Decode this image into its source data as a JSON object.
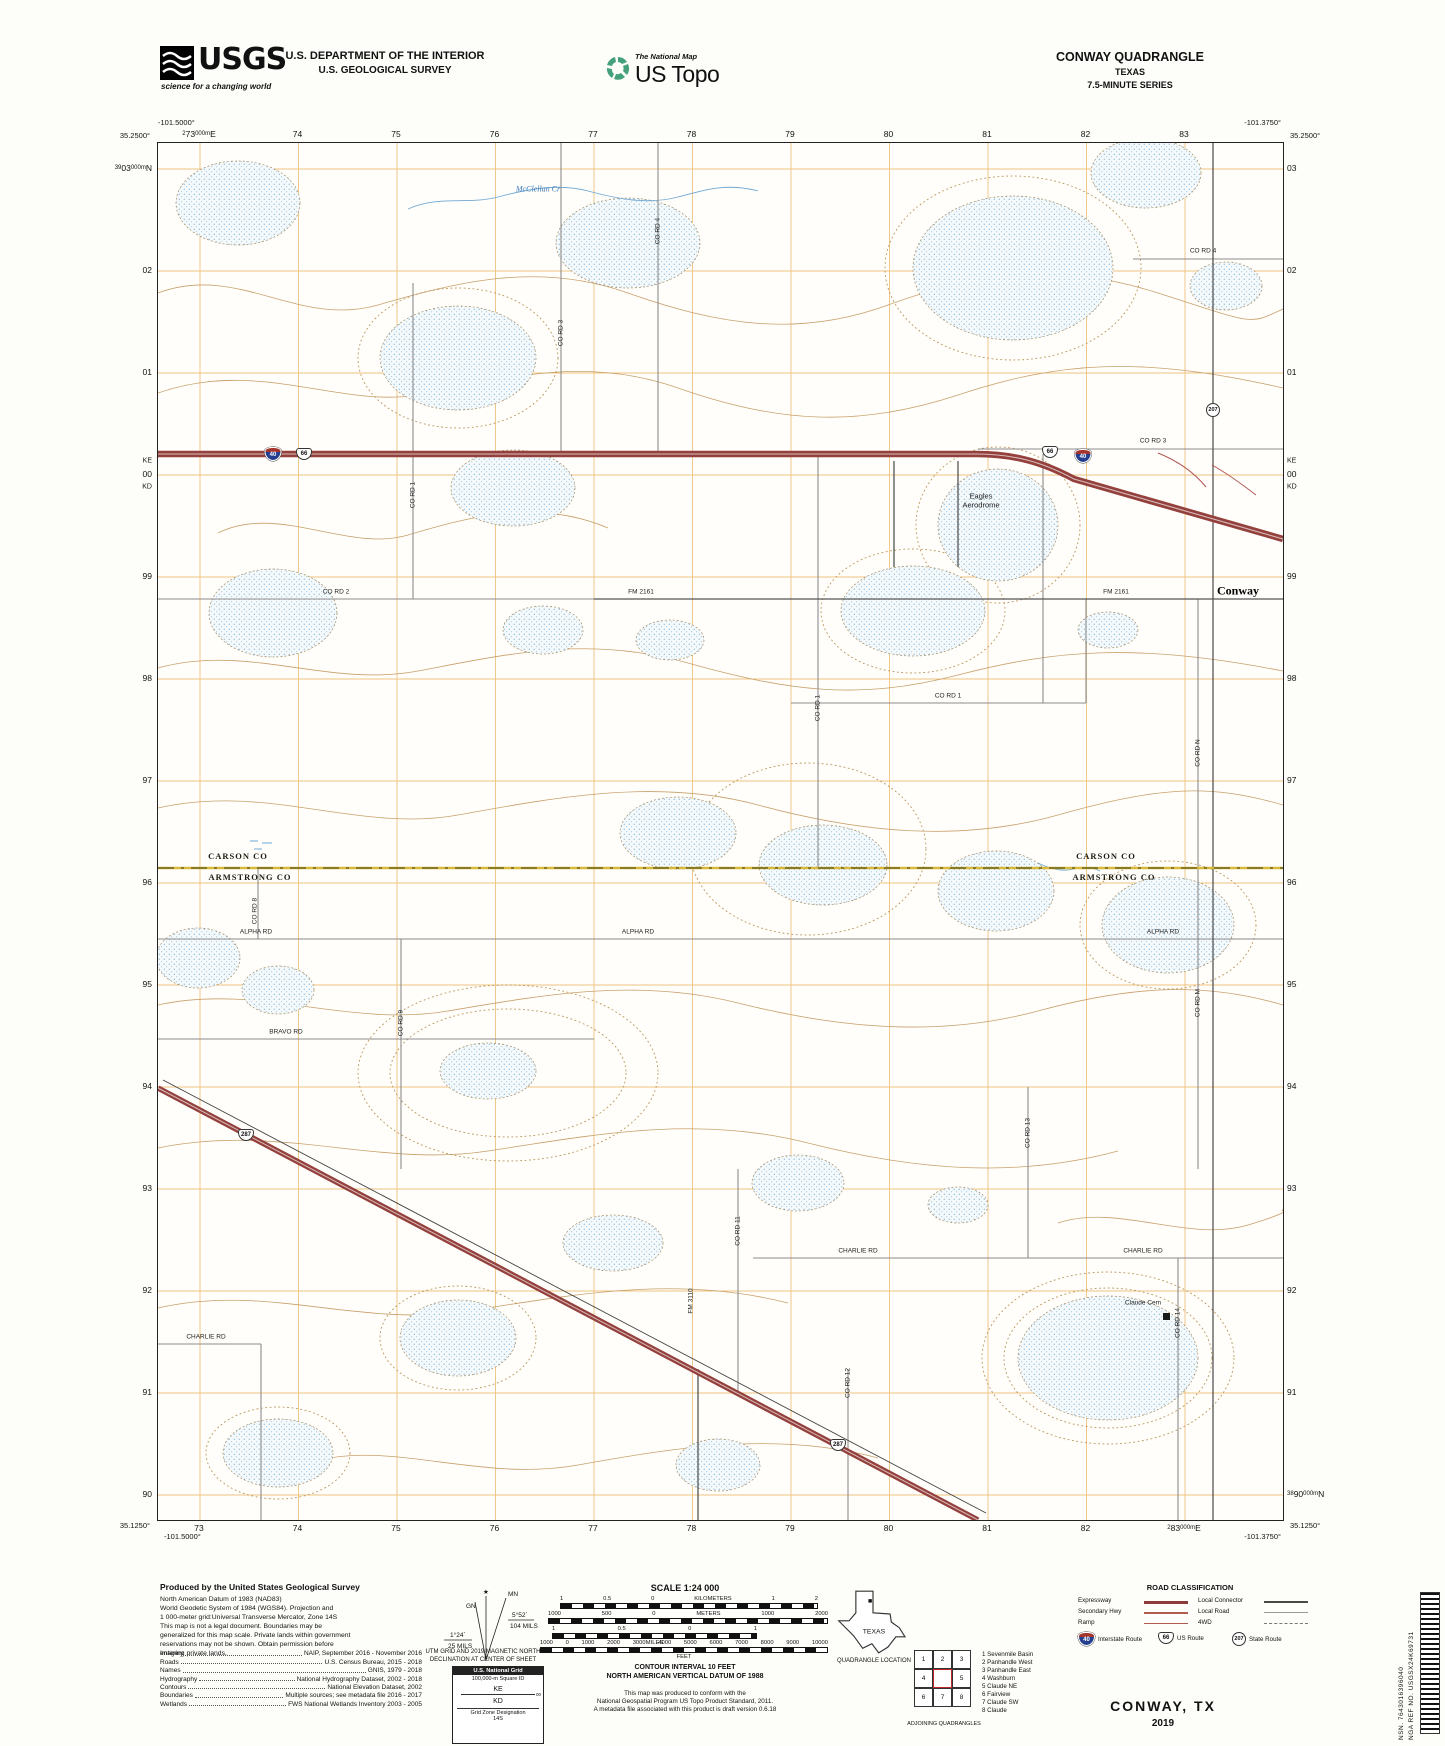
{
  "header": {
    "usgs_logo": "USGS",
    "usgs_tagline": "science for a changing world",
    "dept_line1": "U.S. DEPARTMENT OF THE INTERIOR",
    "dept_line2": "U.S. GEOLOGICAL SURVEY",
    "ustopo_small": "The National Map",
    "ustopo_large": "US Topo",
    "quad_title": "CONWAY QUADRANGLE",
    "quad_state": "TEXAS",
    "quad_series": "7.5-MINUTE SERIES"
  },
  "map": {
    "corners": {
      "tl": {
        "lon": "-101.5000°",
        "lat": "35.2500°"
      },
      "tr": {
        "lon": "-101.3750°",
        "lat": "35.2500°"
      },
      "bl": {
        "lon": "-101.5000°",
        "lat": "35.1250°"
      },
      "br": {
        "lon": "-101.3750°",
        "lat": "35.1250°"
      }
    },
    "edge": {
      "top": [
        [
          [
            "s",
            "2"
          ],
          [
            "b",
            "73"
          ],
          [
            "s",
            "000m"
          ],
          [
            "b",
            "E"
          ]
        ],
        "74",
        "75",
        "76",
        "77",
        "78",
        "79",
        "80",
        "81",
        "82",
        "83"
      ],
      "bottom": [
        "73",
        "74",
        "75",
        "76",
        "77",
        "78",
        "79",
        "80",
        "81",
        "82",
        [
          [
            "s",
            "2"
          ],
          [
            "b",
            "83"
          ],
          [
            "s",
            "000m"
          ],
          [
            "b",
            "E"
          ]
        ]
      ],
      "left": [
        [
          [
            "s",
            "39"
          ],
          [
            "b",
            "03"
          ],
          [
            "s",
            "000m"
          ],
          [
            "b",
            "N"
          ]
        ],
        "02",
        "01",
        "00",
        "99",
        "98",
        "97",
        "96",
        "95",
        "94",
        "93",
        "92",
        "91",
        "90"
      ],
      "right": [
        "03",
        "02",
        "01",
        "00",
        "99",
        "98",
        "97",
        "96",
        "95",
        "94",
        "93",
        "92",
        "91",
        [
          [
            "s",
            "38"
          ],
          [
            "b",
            "90"
          ],
          [
            "s",
            "000m"
          ],
          [
            "b",
            "N"
          ]
        ]
      ],
      "ke": "KE",
      "kd": "KD"
    },
    "labels": [
      {
        "t": "McClellan Cr",
        "x": 380,
        "y": 46,
        "c": "water"
      },
      {
        "t": "CO RD 3",
        "x": 403,
        "y": 190,
        "c": "vroad"
      },
      {
        "t": "CO RD 4",
        "x": 500,
        "y": 88,
        "c": "vroad"
      },
      {
        "t": "CO RD 4",
        "x": 1045,
        "y": 108,
        "c": "road"
      },
      {
        "t": "CO RD 3",
        "x": 995,
        "y": 298,
        "c": "road"
      },
      {
        "t": "CO RD 1",
        "x": 255,
        "y": 352,
        "c": "vroad"
      },
      {
        "t": "Eagles\nAerodrome",
        "x": 823,
        "y": 358,
        "c": "place"
      },
      {
        "t": "Conway",
        "x": 1080,
        "y": 448,
        "c": "town"
      },
      {
        "t": "CO RD 2",
        "x": 178,
        "y": 449,
        "c": "road"
      },
      {
        "t": "FM 2161",
        "x": 483,
        "y": 449,
        "c": "road"
      },
      {
        "t": "FM 2161",
        "x": 958,
        "y": 449,
        "c": "road"
      },
      {
        "t": "CO RD 1",
        "x": 790,
        "y": 553,
        "c": "road"
      },
      {
        "t": "CO RD 1",
        "x": 660,
        "y": 565,
        "c": "vroad"
      },
      {
        "t": "CO RD N",
        "x": 1040,
        "y": 610,
        "c": "vroad"
      },
      {
        "t": "CARSON CO",
        "x": 80,
        "y": 713,
        "c": "county"
      },
      {
        "t": "ARMSTRONG CO",
        "x": 92,
        "y": 734,
        "c": "county"
      },
      {
        "t": "CARSON CO",
        "x": 948,
        "y": 713,
        "c": "county"
      },
      {
        "t": "ARMSTRONG CO",
        "x": 956,
        "y": 734,
        "c": "county"
      },
      {
        "t": "CO RD 8",
        "x": 97,
        "y": 768,
        "c": "vroad"
      },
      {
        "t": "ALPHA RD",
        "x": 98,
        "y": 789,
        "c": "road"
      },
      {
        "t": "ALPHA RD",
        "x": 480,
        "y": 789,
        "c": "road"
      },
      {
        "t": "ALPHA RD",
        "x": 1005,
        "y": 789,
        "c": "road"
      },
      {
        "t": "CO RD 9",
        "x": 243,
        "y": 880,
        "c": "vroad"
      },
      {
        "t": "CO RD M",
        "x": 1040,
        "y": 860,
        "c": "vroad"
      },
      {
        "t": "BRAVO RD",
        "x": 128,
        "y": 889,
        "c": "road"
      },
      {
        "t": "CO RD 13",
        "x": 870,
        "y": 990,
        "c": "vroad"
      },
      {
        "t": "CHARLIE RD",
        "x": 700,
        "y": 1108,
        "c": "road"
      },
      {
        "t": "CHARLIE RD",
        "x": 985,
        "y": 1108,
        "c": "road"
      },
      {
        "t": "CO RD 11",
        "x": 580,
        "y": 1088,
        "c": "vroad"
      },
      {
        "t": "FM 3110",
        "x": 533,
        "y": 1158,
        "c": "vroad"
      },
      {
        "t": "CHARLIE RD",
        "x": 48,
        "y": 1194,
        "c": "road"
      },
      {
        "t": "CO RD 12",
        "x": 690,
        "y": 1240,
        "c": "vroad"
      },
      {
        "t": "CO RD 14",
        "x": 1020,
        "y": 1180,
        "c": "vroad"
      },
      {
        "t": "Claude Cem",
        "x": 985,
        "y": 1160,
        "c": "cem"
      }
    ],
    "shields": [
      {
        "k": "i",
        "n": "40",
        "x": 115,
        "y": 311
      },
      {
        "k": "u",
        "n": "66",
        "x": 146,
        "y": 311
      },
      {
        "k": "u",
        "n": "66",
        "x": 892,
        "y": 309
      },
      {
        "k": "i",
        "n": "40",
        "x": 925,
        "y": 313
      },
      {
        "k": "s",
        "n": "207",
        "x": 1055,
        "y": 267
      },
      {
        "k": "u",
        "n": "287",
        "x": 88,
        "y": 992
      },
      {
        "k": "u",
        "n": "287",
        "x": 680,
        "y": 1302
      }
    ]
  },
  "collar": {
    "produced_by": "Produced by the United States Geological Survey",
    "datum_lines": [
      "North American Datum of 1983 (NAD83)",
      "World Geodetic System of 1984 (WGS84).  Projection and",
      "1 000-meter grid:Universal Transverse Mercator, Zone 14S",
      "This map is not a legal document. Boundaries may be",
      "generalized for this map scale. Private lands within government",
      "reservations may not be shown. Obtain permission before",
      "entering private lands."
    ],
    "credits": [
      {
        "label": "Imagery",
        "value": "NAIP, September 2016 - November 2016"
      },
      {
        "label": "Roads",
        "value": "U.S. Census Bureau, 2015 - 2018"
      },
      {
        "label": "Names",
        "value": "GNIS, 1979 - 2018"
      },
      {
        "label": "Hydrography",
        "value": "National Hydrography Dataset, 2002 - 2018"
      },
      {
        "label": "Contours",
        "value": "National Elevation Dataset, 2002"
      },
      {
        "label": "Boundaries",
        "value": "Multiple sources; see metadata file 2016 - 2017"
      },
      {
        "label": "Wetlands",
        "value": "FWS National Wetlands Inventory 2003 - 2005"
      }
    ],
    "declination": {
      "star": "★",
      "gn": "GN",
      "mn": "MN",
      "east": "5°52´",
      "east_mils": "104 MILS",
      "west": "1°24´",
      "west_mils": "25 MILS",
      "caption1": "UTM GRID AND 2019 MAGNETIC NORTH",
      "caption2": "DECLINATION AT CENTER OF SHEET"
    },
    "usng": {
      "title": "U.S. National Grid",
      "subtitle": "100,000-m Square ID",
      "sq_top": "KE",
      "sq_mid": "00",
      "sq_bottom": "KD",
      "zone_label": "Grid Zone Designation",
      "zone": "14S"
    },
    "scale": {
      "title": "SCALE 1:24 000",
      "bars": [
        {
          "labels": [
            "1",
            "0.5",
            "0",
            "KILOMETERS",
            "1",
            "2"
          ],
          "below": ""
        },
        {
          "labels": [
            "1000",
            "500",
            "0",
            "METERS",
            "1000",
            "2000"
          ],
          "below": ""
        },
        {
          "labels": [
            "1",
            "0.5",
            "0",
            "1"
          ],
          "below": "MILES"
        },
        {
          "labels": [
            "1000",
            "0",
            "1000",
            "2000",
            "3000",
            "4000",
            "5000",
            "6000",
            "7000",
            "8000",
            "9000",
            "10000"
          ],
          "below": "FEET"
        }
      ]
    },
    "contour_note1": "CONTOUR INTERVAL 10 FEET",
    "contour_note2": "NORTH AMERICAN VERTICAL DATUM OF 1988",
    "standard_note": [
      "This map was produced to conform with the",
      "National Geospatial Program US Topo Product Standard, 2011.",
      "A metadata file associated with this product is draft version 0.6.18"
    ],
    "quad_location": {
      "state": "TEXAS",
      "label": "QUADRANGLE LOCATION"
    },
    "adjoining": {
      "caption": "ADJOINING QUADRANGLES",
      "cells": [
        "1",
        "2",
        "3",
        "4",
        "",
        "5",
        "6",
        "7",
        "8"
      ],
      "list": [
        "1 Sevenmile Basin",
        "2 Panhandle West",
        "3 Panhandle East",
        "4 Washburn",
        "5 Claude NE",
        "6 Fairview",
        "7 Claude SW",
        "8 Claude"
      ]
    },
    "road_class": {
      "title": "ROAD CLASSIFICATION",
      "rows": [
        {
          "l": "Expressway",
          "r": "Local Connector"
        },
        {
          "l": "Secondary Hwy",
          "r": "Local Road"
        },
        {
          "l": "Ramp",
          "r": "4WD"
        }
      ],
      "shield_labels": [
        "Interstate Route",
        "US Route",
        "State Route"
      ],
      "shield_numbers": [
        "40",
        "66",
        "207"
      ]
    },
    "map_title": "CONWAY,  TX",
    "map_year": "2019",
    "nsn": "NSN. 7643016396040",
    "nga": "NGA REF NO. USGSX24K69731"
  },
  "colors": {
    "expressway": "#94403c",
    "grid": "#eec27f",
    "contour": "#c8a06a",
    "water_dot": "#8fb8d4",
    "county_line": "#d8b93c",
    "interstate_shield_blue": "#243e8f",
    "interstate_shield_red": "#a5342c",
    "topo_logo_green": "#44a17c"
  }
}
